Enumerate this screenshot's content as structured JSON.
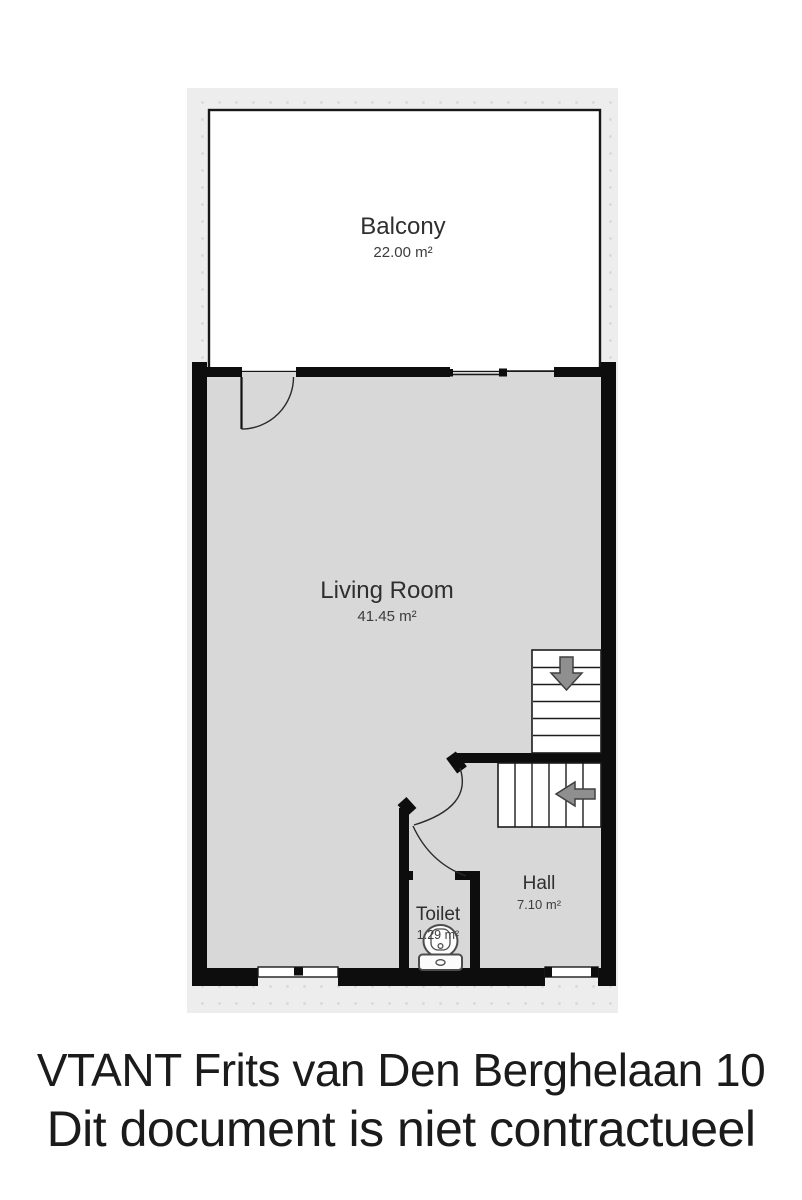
{
  "floorplan": {
    "rooms": [
      {
        "name": "Balcony",
        "area": "22.00 m²"
      },
      {
        "name": "Living Room",
        "area": "41.45 m²"
      },
      {
        "name": "Hall",
        "area": "7.10 m²"
      },
      {
        "name": "Toilet",
        "area": "1.29 m²"
      }
    ]
  },
  "footer": {
    "line1": "VTANT Frits van Den Berghelaan 10",
    "line2": "Dit document is niet contractueel"
  },
  "colors": {
    "wall": "#0d0d0d",
    "floor": "#d8d8d8",
    "backdrop": "#ededed",
    "dot": "#d7d7d7",
    "balcony": "#ffffff",
    "arrow": "#8f8f8f",
    "line": "#1c1c1c",
    "label": "#2f2f2f"
  }
}
